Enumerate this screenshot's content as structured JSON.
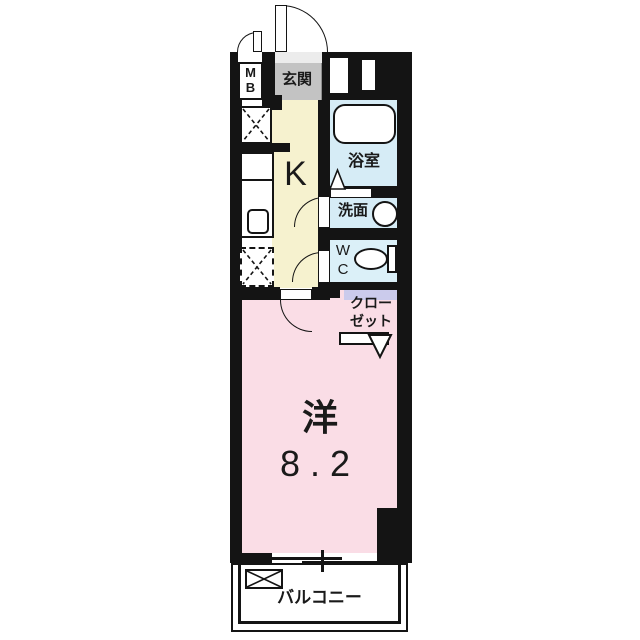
{
  "floorplan": {
    "title": "1K apartment floor plan",
    "rooms": {
      "meter_box": {
        "line1": "M",
        "line2": "B"
      },
      "entrance": {
        "label": "玄関"
      },
      "kitchen": {
        "label": "K"
      },
      "bathroom": {
        "label": "浴室"
      },
      "washroom": {
        "label": "洗面"
      },
      "toilet": {
        "line1": "W",
        "line2": "C"
      },
      "closet": {
        "line1": "クロー",
        "line2": "ゼット"
      },
      "main_room": {
        "label": "洋",
        "size": "8.2"
      },
      "balcony": {
        "label": "バルコニー"
      }
    },
    "colors": {
      "wall": "#141414",
      "kitchen_floor": "#f6f2cf",
      "main_room_floor": "#fadde6",
      "bathroom_floor": "#d6ecf6",
      "toilet_floor": "#dbf0f8",
      "closet_floor": "#cbcbec",
      "entrance_floor": "#c3c3c3",
      "background": "#ffffff"
    }
  }
}
